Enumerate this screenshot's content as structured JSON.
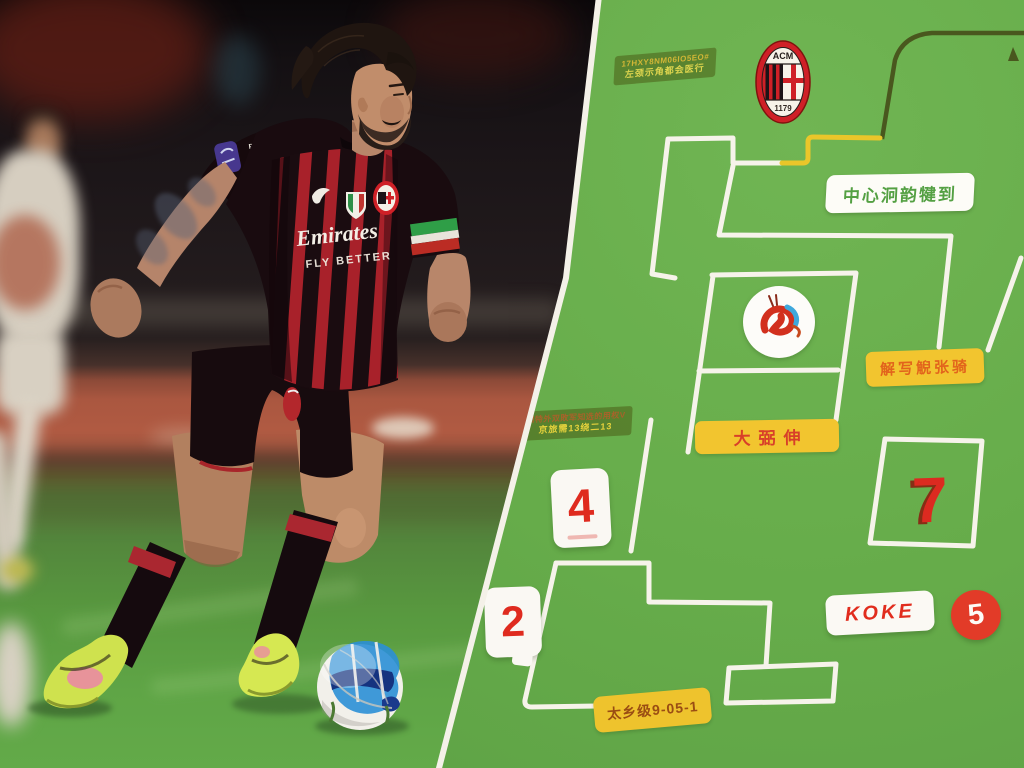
{
  "panel": {
    "milan_crest": {
      "initials": "ACM",
      "year": "1179"
    },
    "notes": {
      "top": {
        "line1": "17HXY8NM06IO5EO#",
        "line2": "左颈示角都会医行"
      },
      "mid": {
        "line1": "知特外双敗军知选的用权V",
        "line2": "京旅需13绕二13"
      }
    },
    "labels": {
      "center": "中心泂韵犍到",
      "right": "解写觬张骑",
      "middle": "大弼伸",
      "bottom": "太乡级9-05-1",
      "koke": "KOKE"
    },
    "numbers": {
      "card_top": "4",
      "card_bottom": "2",
      "outlined": "7",
      "badge": "5"
    },
    "colors": {
      "pitch_green": "#64aa49",
      "line_white": "#f6f3ea",
      "accent_yellow": "#eec62c",
      "accent_red": "#df2b1f",
      "line_dark": "#49571e"
    }
  },
  "photo": {
    "sponsor": "Emirates",
    "slogan": "FLY BETTER",
    "brand": "PUMA"
  }
}
